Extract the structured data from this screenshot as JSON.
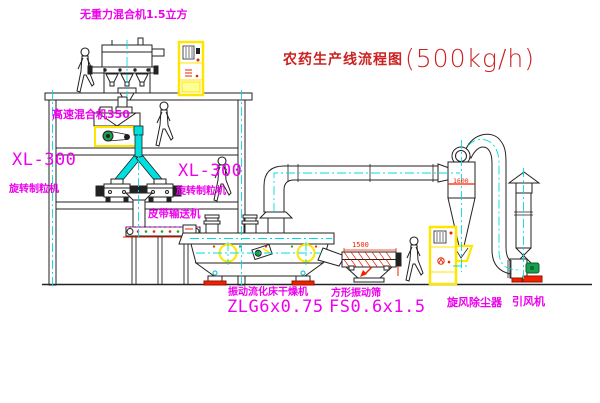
{
  "title": {
    "name": "农药生产线流程图",
    "capacity": "(500kg/h)"
  },
  "equipment": {
    "gravity_mixer": {
      "label": "无重力混合机1.5立方"
    },
    "high_speed_mixer": {
      "label": "高速混合机350"
    },
    "granulator_left": {
      "model": "XL-300",
      "label": "旋转制粒机"
    },
    "granulator_right": {
      "model": "XL-300",
      "label": "旋转制粒机"
    },
    "belt_conveyor": {
      "label": "皮带输送机"
    },
    "dryer": {
      "label": "振动流化床干燥机",
      "model": "ZLG6x0.75"
    },
    "screen": {
      "label": "方形振动筛",
      "model": "FS0.6x1.5",
      "width_dimension": "1500"
    },
    "cyclone": {
      "label": "旋风除尘器",
      "height_dimension": "1600"
    },
    "fan": {
      "label": "引风机"
    }
  },
  "colors": {
    "background": "#ffffff",
    "line": "#222222",
    "centerline_cyan": "#00dddd",
    "duct_cyan": "#00e0e0",
    "equipment_yellow": "#ffe600",
    "label_magenta": "#ee00ee",
    "title_red": "#cc2222",
    "accent_red": "#ee2200",
    "motor_green": "#18a04c"
  }
}
